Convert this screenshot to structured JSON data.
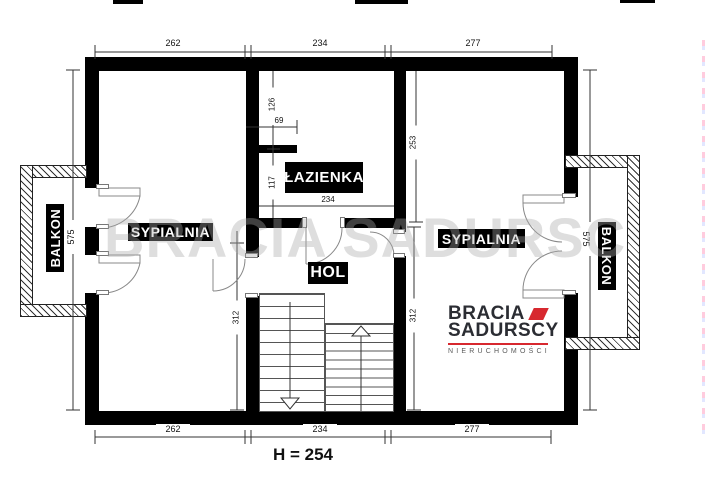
{
  "plan": {
    "watermark": "BRACIA SADURSCY",
    "footer_note": "H = 254"
  },
  "rooms": {
    "balkon_left": "BALKON",
    "sypialnia_left": "SYPIALNIA",
    "lazienka": "ŁAZIENKA",
    "hol": "HOL",
    "sypialnia_right": "SYPIALNIA",
    "balkon_right": "BALKON"
  },
  "dimensions": {
    "top": [
      "262",
      "234",
      "277"
    ],
    "bottom": [
      "262",
      "234",
      "277"
    ],
    "side_left": "575",
    "side_right": "575",
    "interior": {
      "bath_upper_segment": "126",
      "bath_stub": "69",
      "bath_lower_segment": "117",
      "bath_width": "234",
      "bedroom_right_depth": "253",
      "hol_depth_left": "312",
      "hol_depth_right": "312"
    }
  },
  "logo": {
    "brand_line1": "BRACIA",
    "brand_line2": "SADURSCY",
    "tagline": "NIERUCHOMOŚCI"
  },
  "colors": {
    "wall": "#000000",
    "label_bg": "#000000",
    "label_text": "#ffffff",
    "logo_text": "#2b2d33",
    "logo_red": "#d7282f"
  }
}
